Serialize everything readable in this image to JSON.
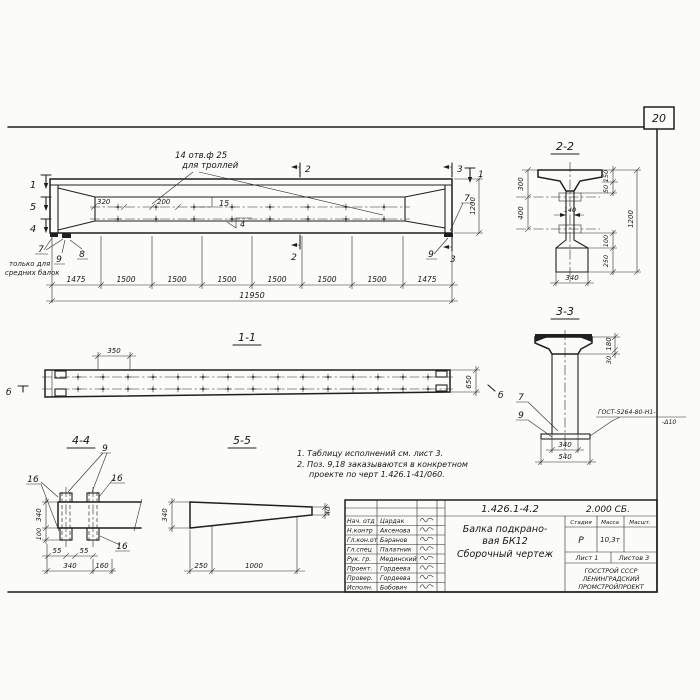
{
  "page": {
    "number": "20"
  },
  "main_view": {
    "holes_note": [
      "14 отв.ф 25",
      "для троллей"
    ],
    "markers": {
      "m1": "1",
      "m5": "5",
      "m4": "4",
      "m2": "2",
      "m3": "3",
      "m1r": "1"
    },
    "dims": {
      "d320": "320",
      "d200": "200",
      "d1200": "1200",
      "total": "11950"
    },
    "chain": [
      "1475",
      "1500",
      "1500",
      "1500",
      "1500",
      "1500",
      "1500",
      "1475"
    ],
    "pos": {
      "p15": "15",
      "p4": "4",
      "p7l": "7",
      "p9l": "9",
      "p8": "8",
      "p7r": "7",
      "p9r": "9"
    },
    "note_mid_beams": [
      "только для",
      "средних балок"
    ]
  },
  "section_2_2": {
    "title": "2-2",
    "dims": {
      "d300": "300",
      "d400": "400",
      "d150": "150",
      "d50": "50",
      "d100": "100",
      "d250": "250",
      "d1200": "1200",
      "d140": "140",
      "d340": "340"
    }
  },
  "section_3_3": {
    "title": "3-3",
    "dims": {
      "d180": "180",
      "d30": "30",
      "d340": "340",
      "d540": "540"
    },
    "pos": {
      "p7": "7",
      "p9": "9"
    },
    "weld_note": [
      "ГОСТ-5264-80-Н1-",
      "-Δ10"
    ]
  },
  "view_1_1": {
    "title": "1-1",
    "dims": {
      "d350": "350",
      "d650": "650"
    },
    "marker": "б"
  },
  "section_4_4": {
    "title": "4-4",
    "pos": {
      "p16a": "16",
      "p9": "9",
      "p16b": "16",
      "p16c": "16"
    },
    "dims": {
      "d340_left": "340",
      "d100": "100",
      "d55a": "55",
      "d55b": "55",
      "d340_bottom": "340",
      "d160": "160"
    }
  },
  "section_5_5": {
    "title": "5-5",
    "dims": {
      "d340": "340",
      "d40": "40",
      "d250": "250",
      "d1000": "1000"
    }
  },
  "notes": [
    "1. Таблицу исполнений см. лист 3.",
    "2. Поз. 9,18 заказываются в конкретном",
    "проекте по черт 1.426.1-41/060."
  ],
  "title_block": {
    "doc_number": "1.426.1-4.2",
    "doc_code": "2.000 СБ.",
    "signature_rows": [
      {
        "role": "Нач. отд",
        "name": "Цардак"
      },
      {
        "role": "Н.контр",
        "name": "Аксенова"
      },
      {
        "role": "Гл.кон.от",
        "name": "Баранов"
      },
      {
        "role": "Гл.спец",
        "name": "Палатник"
      },
      {
        "role": "Рук. гр.",
        "name": "Мединский"
      },
      {
        "role": "Проект.",
        "name": "Гордеева"
      },
      {
        "role": "Провер.",
        "name": "Гордеева"
      },
      {
        "role": "Исполн.",
        "name": "Бобович"
      }
    ],
    "product_title": [
      "Балка подкрано-",
      "вая БК12",
      "Сборочный чертеж"
    ],
    "columns": {
      "stage": "Стадия",
      "mass": "Масса",
      "scale": "Масшт."
    },
    "values": {
      "stage": "Р",
      "mass": "10,3т"
    },
    "sheet": "Лист 1",
    "sheets": "Листов 3",
    "organization": [
      "ГОССТРОЙ СССР",
      "ЛЕНИНГРАДСКИЙ",
      "ПРОМСТРОЙПРОЕКТ"
    ]
  }
}
